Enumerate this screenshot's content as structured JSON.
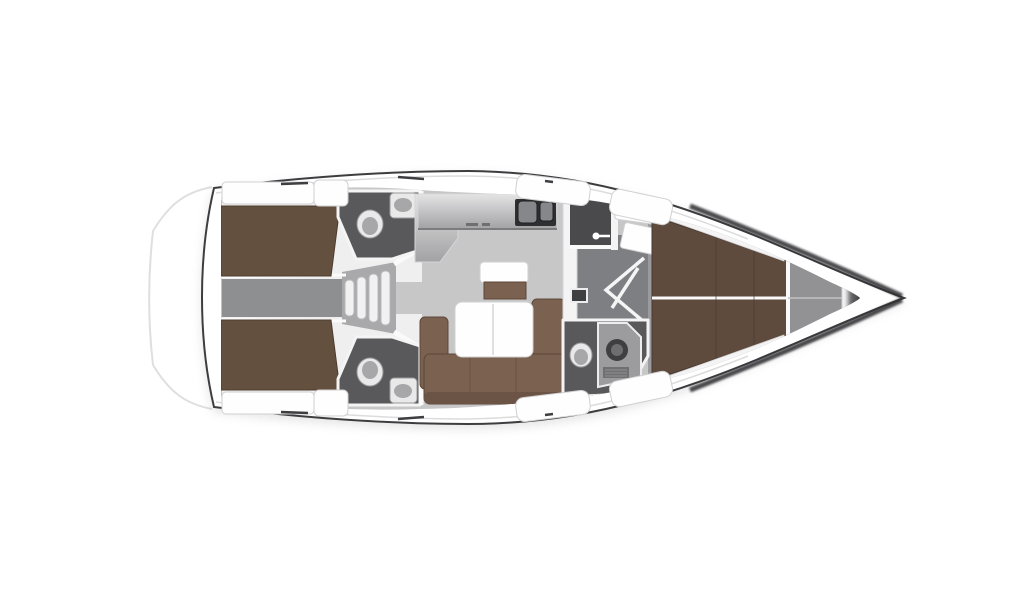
{
  "canvas": {
    "width": 1024,
    "height": 600,
    "background": "#ffffff"
  },
  "diagram": {
    "type": "yacht-floor-plan",
    "orientation": "bow-right",
    "rooms": [
      "aft-cabin-port",
      "aft-cabin-starboard",
      "aft-head-port",
      "aft-head-starboard",
      "companionway-stairs",
      "galley",
      "salon",
      "nav-seat",
      "mid-corridor",
      "forward-head",
      "forward-cabin",
      "anchor-locker",
      "bow"
    ]
  },
  "colors": {
    "background": "#ffffff",
    "hullFill": "#ffffff",
    "hullStroke": "#3e3e41",
    "innerDeckLine": "#dcdcdd",
    "faintLine": "#dfdfe0",
    "floor": "#c7c7c8",
    "cabinWhite": "#efefef",
    "corridor": "#8e8f91",
    "stairwell": "#a9a9ab",
    "midCorridor": "#7e7f82",
    "forwardFloor": "#9b9b9d",
    "lockerFloor": "#929295",
    "headFloor": "#59595b",
    "darkRoom": "#4a4a4c",
    "wall": "#f4f4f5",
    "wallEdge": "#d6d6d8",
    "wallLine": "#fafafa",
    "shadowStrip": "#c3c3c5",
    "bedBrown": "#64503f",
    "bedEdge": "#4d3c2f",
    "sofaBrown": "#7a6150",
    "sofaEdge": "#5d483a",
    "sofaBack": "#6b5445",
    "berthBrown": "#5e4b3d",
    "berthEdge": "#49392e",
    "berthSeam": "#4a3a2f",
    "counterLight": "#e4e4e5",
    "counterMid": "#a2a2a4",
    "counterEdge": "#7c7c7e",
    "counterMark": "#6f6f71",
    "sinkDark": "#2f2f31",
    "sinkInner": "#85878a",
    "sinkRim": "#1f1f21",
    "fixtureWhite": "#e9e9ea",
    "fixtureRim": "#9a9a9c",
    "fixtureInner": "#a7a7a9",
    "stepFill": "#f1f1f2",
    "stepStroke": "#b9b9bb",
    "showerPanel": "#9c9c9e",
    "showerEdge": "#ededef",
    "drainDark": "#3f3f41",
    "drainMid": "#6e6e70",
    "ventGray": "#707072",
    "ventLine": "#8f8f91",
    "doorLine": "#f5f5f6",
    "handleWhite": "#ffffff",
    "bow0": "#737375",
    "bow1": "#2c2c2e",
    "bow2": "#18181a",
    "bow3": "#808082",
    "hullWedge": "#2c2c2e",
    "centerline": "#c2c2c4",
    "hatchFill": "#fefefe",
    "hatchStroke": "#d0d0d2",
    "dashDark": "#3e3e41"
  }
}
